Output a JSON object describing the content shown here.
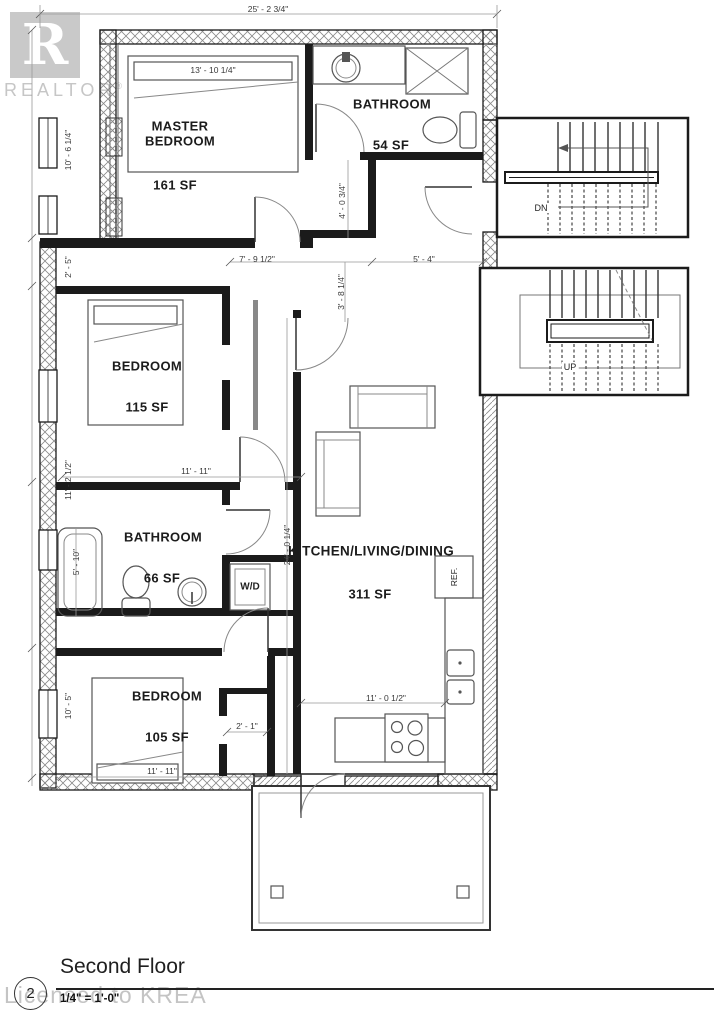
{
  "watermarks": {
    "realtor_logo_letter": "R",
    "realtor_text": "REALTOR",
    "registered_mark": "®",
    "licensed_text": "Licensed to KREA"
  },
  "title_block": {
    "sheet_number": "2",
    "title": "Second Floor",
    "scale": "1/4\" = 1'-0\""
  },
  "rooms": {
    "master_bedroom": {
      "name": "MASTER BEDROOM",
      "area": "161 SF"
    },
    "bathroom_upper": {
      "name": "BATHROOM",
      "area": "54 SF"
    },
    "bedroom_mid": {
      "name": "BEDROOM",
      "area": "115 SF"
    },
    "bathroom_lower": {
      "name": "BATHROOM",
      "area": "66 SF"
    },
    "bedroom_lower": {
      "name": "BEDROOM",
      "area": "105 SF"
    },
    "kitchen_living_dining": {
      "name": "KITCHEN/LIVING/DINING",
      "area": "311 SF"
    }
  },
  "stairs": {
    "down_label": "DN",
    "up_label": "UP"
  },
  "appliances": {
    "refrigerator": "REF.",
    "washer_dryer": "W/D"
  },
  "dimensions": {
    "overall_width": "25' - 2 3/4\"",
    "master_bed_width": "13' - 10 1/4\"",
    "master_depth": "10' - 6 1/4\"",
    "hall_upper": "2' - 5\"",
    "bath_upper_entry": "4' - 0 3/4\"",
    "hall_width": "7' - 9 1/2\"",
    "entry_width": "5' - 4\"",
    "hall_depth": "3' - 8 1/4\"",
    "bedroom_mid_depth": "11' - 2 1/2\"",
    "bedroom_mid_width": "11' - 11\"",
    "kitchen_depth": "24' - 0 1/4\"",
    "bath_lower_width": "5' - 10\"",
    "bedroom_lower_depth": "10' - 5\"",
    "closet_width": "2' - 1\"",
    "bedroom_lower_width": "11' - 11\"",
    "kitchen_width": "11' - 0 1/2\""
  },
  "colors": {
    "wall": "#1b1b1b",
    "dimension_text": "#3a3a3a",
    "watermark": "#c4c4c4",
    "background": "#ffffff"
  }
}
